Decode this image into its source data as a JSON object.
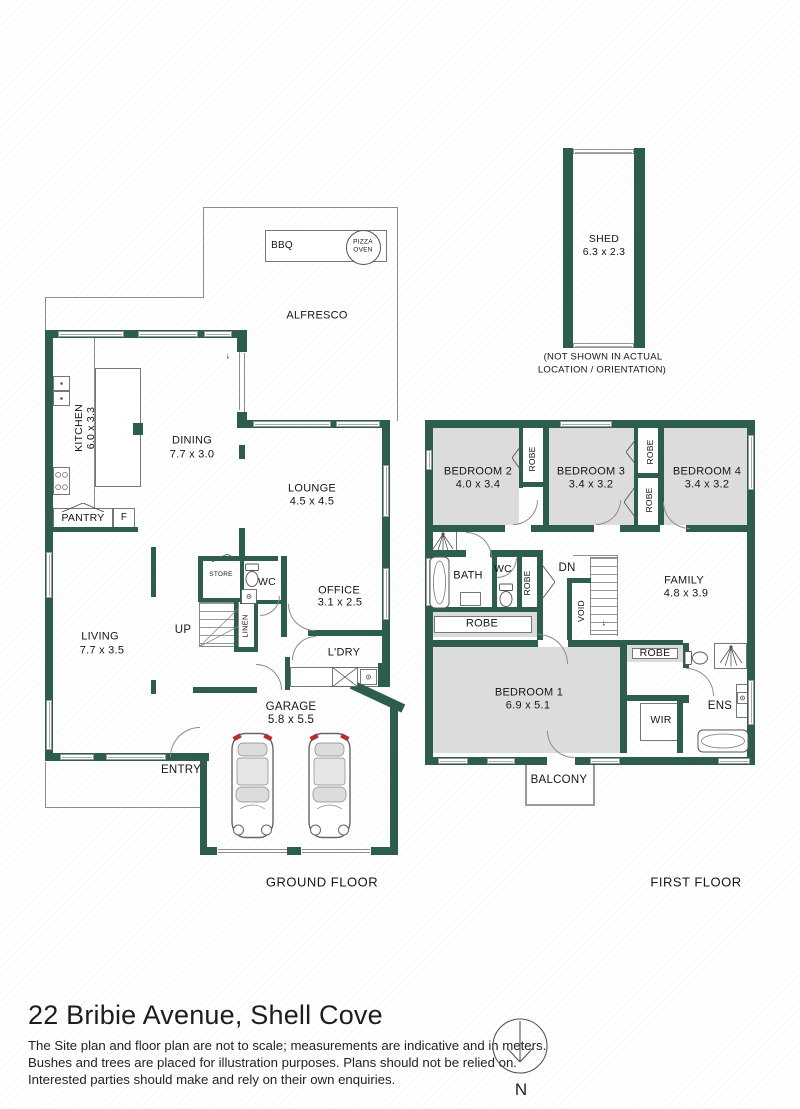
{
  "meta": {
    "title": "22 Bribie Avenue, Shell Cove",
    "disclaimer": [
      "The Site plan and floor plan are not to scale; measurements are indicative and in meters.",
      "Bushes and trees are placed for illustration purposes. Plans should not be relied on.",
      "Interested parties should make and rely on their own enquiries."
    ],
    "ground_floor_label": "GROUND FLOOR",
    "first_floor_label": "FIRST FLOOR",
    "compass_label": "N"
  },
  "colors": {
    "wall": "#2d5d4b",
    "room_fill": "#dcdcdc",
    "thin_line": "#8c8c8c",
    "text": "#161616",
    "tail_light": "#b03030"
  },
  "plan": {
    "walls": [
      [
        45,
        330,
        8,
        431
      ],
      [
        45,
        330,
        194,
        8
      ],
      [
        237,
        330,
        10,
        22
      ],
      [
        237,
        412,
        10,
        16
      ],
      [
        237,
        420,
        153,
        8
      ],
      [
        382,
        420,
        8,
        247
      ],
      [
        378,
        663,
        12,
        24
      ],
      [
        45,
        753,
        152,
        8
      ],
      [
        197,
        753,
        12,
        8
      ],
      [
        200,
        755,
        7,
        100
      ],
      [
        200,
        847,
        17,
        8
      ],
      [
        287,
        847,
        14,
        8
      ],
      [
        371,
        847,
        27,
        8
      ],
      [
        390,
        704,
        8,
        151
      ],
      [
        349,
        692,
        57,
        9,
        25
      ],
      [
        193,
        687,
        64,
        6
      ],
      [
        285,
        657,
        5,
        33
      ],
      [
        151,
        547,
        5,
        50
      ],
      [
        151,
        680,
        5,
        14
      ],
      [
        53,
        527,
        85,
        5
      ],
      [
        198,
        556,
        80,
        5
      ],
      [
        281,
        556,
        6,
        81
      ],
      [
        308,
        630,
        80,
        6
      ],
      [
        198,
        556,
        5,
        46
      ],
      [
        240,
        558,
        4,
        44
      ],
      [
        198,
        598,
        44,
        4
      ],
      [
        240,
        600,
        45,
        4
      ],
      [
        234,
        602,
        4,
        50
      ],
      [
        254,
        602,
        4,
        50
      ],
      [
        234,
        647,
        24,
        5
      ],
      [
        133,
        423,
        10,
        12
      ],
      [
        239,
        445,
        6,
        14
      ],
      [
        239,
        528,
        6,
        30
      ],
      [
        425,
        420,
        330,
        8
      ],
      [
        425,
        420,
        8,
        345
      ],
      [
        747,
        420,
        8,
        345
      ],
      [
        425,
        757,
        330,
        8
      ],
      [
        425,
        525,
        330,
        7
      ],
      [
        543,
        428,
        6,
        97
      ],
      [
        519,
        428,
        4,
        60
      ],
      [
        519,
        482,
        28,
        5
      ],
      [
        634,
        428,
        4,
        97
      ],
      [
        658,
        428,
        6,
        97
      ],
      [
        634,
        473,
        28,
        5
      ],
      [
        425,
        550,
        41,
        7
      ],
      [
        490,
        550,
        53,
        7
      ],
      [
        492,
        557,
        5,
        50
      ],
      [
        517,
        557,
        5,
        50
      ],
      [
        537,
        557,
        6,
        85
      ],
      [
        425,
        607,
        118,
        5
      ],
      [
        425,
        640,
        202,
        7
      ],
      [
        620,
        643,
        7,
        110
      ],
      [
        567,
        578,
        5,
        64
      ],
      [
        567,
        578,
        24,
        5
      ],
      [
        683,
        643,
        6,
        25
      ],
      [
        683,
        695,
        6,
        8
      ],
      [
        627,
        695,
        56,
        6
      ],
      [
        677,
        701,
        6,
        52
      ],
      [
        627,
        640,
        56,
        5
      ],
      [
        563,
        148,
        10,
        200
      ],
      [
        634,
        148,
        11,
        200
      ]
    ],
    "gaps": [
      [
        505,
        525,
        26,
        7
      ],
      [
        594,
        525,
        26,
        7
      ],
      [
        660,
        525,
        26,
        7
      ],
      [
        538,
        640,
        30,
        7
      ],
      [
        547,
        757,
        28,
        8
      ]
    ],
    "windows": [
      [
        58,
        331,
        66,
        6
      ],
      [
        138,
        331,
        60,
        6
      ],
      [
        204,
        331,
        28,
        6
      ],
      [
        253,
        421,
        78,
        6
      ],
      [
        336,
        421,
        44,
        6
      ],
      [
        46,
        552,
        6,
        46
      ],
      [
        46,
        700,
        6,
        50
      ],
      [
        383,
        465,
        6,
        52
      ],
      [
        383,
        568,
        6,
        52
      ],
      [
        60,
        754,
        34,
        6
      ],
      [
        106,
        754,
        60,
        6
      ],
      [
        560,
        421,
        52,
        6
      ],
      [
        426,
        450,
        6,
        20
      ],
      [
        426,
        558,
        6,
        48
      ],
      [
        748,
        435,
        6,
        55
      ],
      [
        748,
        680,
        6,
        45
      ],
      [
        438,
        758,
        30,
        6
      ],
      [
        487,
        758,
        28,
        6
      ],
      [
        590,
        758,
        30,
        6
      ],
      [
        718,
        758,
        32,
        6
      ],
      [
        573,
        149,
        61,
        5
      ],
      [
        573,
        343,
        61,
        5
      ]
    ],
    "fills": [
      [
        433,
        428,
        86,
        97
      ],
      [
        549,
        428,
        85,
        97
      ],
      [
        664,
        428,
        83,
        97
      ],
      [
        433,
        647,
        187,
        106
      ],
      [
        428,
        612,
        110,
        25
      ],
      [
        627,
        645,
        56,
        17
      ]
    ],
    "lines": [
      [
        203,
        207,
        195,
        1
      ],
      [
        397,
        207,
        1,
        214
      ],
      [
        203,
        207,
        1,
        91
      ],
      [
        45,
        297,
        158,
        1
      ],
      [
        45,
        297,
        1,
        34
      ],
      [
        45,
        762,
        1,
        46
      ],
      [
        45,
        807,
        156,
        1
      ],
      [
        300,
        230,
        1,
        32
      ],
      [
        94,
        338,
        1,
        170
      ],
      [
        573,
        555,
        45,
        1
      ],
      [
        617,
        555,
        1,
        81
      ],
      [
        218,
        849,
        69,
        1
      ],
      [
        218,
        852,
        69,
        1
      ],
      [
        302,
        849,
        68,
        1
      ],
      [
        302,
        852,
        68,
        1
      ],
      [
        239,
        348,
        1,
        62
      ],
      [
        244,
        353,
        1,
        60
      ]
    ],
    "benches": [
      [
        265,
        230,
        122,
        32
      ],
      [
        95,
        368,
        46,
        119
      ],
      [
        53,
        508,
        60,
        20
      ],
      [
        113,
        508,
        22,
        20
      ],
      [
        290,
        667,
        91,
        20
      ],
      [
        434,
        616,
        98,
        17
      ],
      [
        632,
        648,
        46,
        11
      ],
      [
        640,
        703,
        38,
        38
      ],
      [
        736,
        684,
        12,
        34
      ],
      [
        460,
        592,
        21,
        14
      ],
      [
        429,
        530,
        28,
        25
      ],
      [
        714,
        643,
        33,
        26
      ]
    ],
    "balcony": [
      525,
      762,
      70,
      44
    ],
    "doors": [
      {
        "x": 170,
        "y": 727,
        "r": 30,
        "c": "tl"
      },
      {
        "x": 288,
        "y": 604,
        "r": 27,
        "c": "bl"
      },
      {
        "x": 256,
        "y": 664,
        "r": 26,
        "c": "tr"
      },
      {
        "x": 260,
        "y": 596,
        "r": 20,
        "c": "br"
      },
      {
        "x": 292,
        "y": 636,
        "r": 24,
        "c": "tl"
      },
      {
        "x": 513,
        "y": 500,
        "r": 25,
        "c": "br"
      },
      {
        "x": 596,
        "y": 500,
        "r": 25,
        "c": "br"
      },
      {
        "x": 663,
        "y": 502,
        "r": 27,
        "c": "bl"
      },
      {
        "x": 466,
        "y": 532,
        "r": 26,
        "c": "tr"
      },
      {
        "x": 497,
        "y": 558,
        "r": 20,
        "c": "br"
      },
      {
        "x": 538,
        "y": 634,
        "r": 30,
        "c": "tr"
      },
      {
        "x": 547,
        "y": 731,
        "r": 27,
        "c": "bl"
      },
      {
        "x": 686,
        "y": 668,
        "r": 28,
        "c": "tr"
      }
    ],
    "stairs": [
      [
        199,
        602,
        40,
        45
      ],
      [
        590,
        557,
        28,
        78
      ]
    ],
    "fixtures": [
      {
        "k": "sink2",
        "x": 53,
        "y": 376,
        "w": 17,
        "h": 30
      },
      {
        "k": "stove",
        "x": 53,
        "y": 467,
        "w": 17,
        "h": 28
      },
      {
        "k": "toilet",
        "x": 244,
        "y": 563,
        "w": 16,
        "h": 24
      },
      {
        "k": "basin",
        "x": 241,
        "y": 589,
        "w": 16,
        "h": 15
      },
      {
        "k": "toilet",
        "x": 498,
        "y": 583,
        "w": 16,
        "h": 24
      },
      {
        "k": "toilet",
        "x": 688,
        "y": 646,
        "w": 16,
        "h": 24,
        "r": -90
      },
      {
        "k": "tub",
        "x": 429,
        "y": 556,
        "w": 21,
        "h": 53
      },
      {
        "k": "tub",
        "x": 697,
        "y": 729,
        "w": 52,
        "h": 24
      },
      {
        "k": "shower",
        "x": 431,
        "y": 531,
        "w": 24,
        "h": 23
      },
      {
        "k": "shower",
        "x": 718,
        "y": 644,
        "w": 26,
        "h": 24
      },
      {
        "k": "xbox",
        "x": 332,
        "y": 667,
        "w": 26,
        "h": 20
      },
      {
        "k": "basin",
        "x": 360,
        "y": 669,
        "w": 17,
        "h": 16
      },
      {
        "k": "basin",
        "x": 737,
        "y": 691,
        "w": 11,
        "h": 12
      },
      {
        "k": "circle",
        "x": 346,
        "y": 230,
        "w": 33,
        "h": 33
      },
      {
        "k": "car",
        "x": 230,
        "y": 731,
        "w": 45,
        "h": 109
      },
      {
        "k": "car",
        "x": 307,
        "y": 731,
        "w": 45,
        "h": 109
      },
      {
        "k": "chev",
        "x": 62,
        "y": 499,
        "w": 42,
        "h": 9,
        "d": "up"
      },
      {
        "k": "chev",
        "x": 212,
        "y": 549,
        "w": 30,
        "h": 8,
        "d": "up"
      },
      {
        "k": "chev",
        "x": 512,
        "y": 443,
        "w": 11,
        "h": 30,
        "d": "left"
      },
      {
        "k": "chev",
        "x": 626,
        "y": 438,
        "w": 11,
        "h": 28,
        "d": "left"
      },
      {
        "k": "chev",
        "x": 624,
        "y": 487,
        "w": 11,
        "h": 30,
        "d": "left"
      },
      {
        "k": "chev",
        "x": 543,
        "y": 566,
        "w": 12,
        "h": 32,
        "d": "right"
      },
      {
        "k": "diag",
        "x": 199,
        "y": 602,
        "w": 40,
        "h": 45
      }
    ],
    "labels": [
      {
        "t": "BBQ",
        "x": 282,
        "y": 246,
        "s": 10
      },
      {
        "t": "PIZZA\nOVEN",
        "x": 363,
        "y": 246,
        "s": 6.5
      },
      {
        "t": "ALFRESCO",
        "x": 317,
        "y": 316,
        "s": 11
      },
      {
        "t": "KITCHEN",
        "x": 79,
        "y": 428,
        "s": 10.5,
        "r": -90
      },
      {
        "t": "6.0 x 3.3",
        "x": 91,
        "y": 428,
        "s": 10.5,
        "r": -90
      },
      {
        "t": "DINING",
        "x": 192,
        "y": 441,
        "s": 11
      },
      {
        "t": "7.7 x 3.0",
        "x": 192,
        "y": 455,
        "s": 11
      },
      {
        "t": "LOUNGE",
        "x": 312,
        "y": 489,
        "s": 11
      },
      {
        "t": "4.5 x 4.5",
        "x": 312,
        "y": 502,
        "s": 11
      },
      {
        "t": "PANTRY",
        "x": 83,
        "y": 518,
        "s": 10.5
      },
      {
        "t": "F",
        "x": 124,
        "y": 518,
        "s": 10
      },
      {
        "t": "STORE",
        "x": 221,
        "y": 575,
        "s": 6.5
      },
      {
        "t": "WC",
        "x": 267,
        "y": 582,
        "s": 10.5
      },
      {
        "t": "LINEN",
        "x": 246,
        "y": 626,
        "s": 7.5,
        "r": -90
      },
      {
        "t": "OFFICE",
        "x": 339,
        "y": 591,
        "s": 11
      },
      {
        "t": "3.1 x 2.5",
        "x": 340,
        "y": 603,
        "s": 11
      },
      {
        "t": "UP",
        "x": 183,
        "y": 631,
        "s": 11.5
      },
      {
        "t": "L'DRY",
        "x": 344,
        "y": 653,
        "s": 11
      },
      {
        "t": "LIVING",
        "x": 100,
        "y": 637,
        "s": 11
      },
      {
        "t": "7.7 x 3.5",
        "x": 102,
        "y": 651,
        "s": 11
      },
      {
        "t": "ENTRY",
        "x": 181,
        "y": 771,
        "s": 11.5
      },
      {
        "t": "GARAGE",
        "x": 291,
        "y": 708,
        "s": 11.5
      },
      {
        "t": "5.8 x 5.5",
        "x": 291,
        "y": 721,
        "s": 11.5
      },
      {
        "t": "↓",
        "x": 228,
        "y": 356,
        "s": 9
      },
      {
        "t": "BEDROOM 2",
        "x": 478,
        "y": 472,
        "s": 11
      },
      {
        "t": "4.0 x 3.4",
        "x": 478,
        "y": 485,
        "s": 11
      },
      {
        "t": "ROBE",
        "x": 532,
        "y": 459,
        "s": 8.5,
        "r": -90
      },
      {
        "t": "BEDROOM 3",
        "x": 591,
        "y": 472,
        "s": 11
      },
      {
        "t": "3.4 x 3.2",
        "x": 591,
        "y": 485,
        "s": 11
      },
      {
        "t": "ROBE",
        "x": 650,
        "y": 452,
        "s": 8.5,
        "r": -90
      },
      {
        "t": "ROBE",
        "x": 649,
        "y": 500,
        "s": 8.5,
        "r": -90
      },
      {
        "t": "BEDROOM 4",
        "x": 707,
        "y": 472,
        "s": 11
      },
      {
        "t": "3.4 x 3.2",
        "x": 707,
        "y": 485,
        "s": 11
      },
      {
        "t": "BATH",
        "x": 468,
        "y": 576,
        "s": 11
      },
      {
        "t": "WC",
        "x": 503,
        "y": 569,
        "s": 10.5
      },
      {
        "t": "ROBE",
        "x": 527,
        "y": 583,
        "s": 8.5,
        "r": -90
      },
      {
        "t": "DN",
        "x": 567,
        "y": 569,
        "s": 11.5
      },
      {
        "t": "VOID",
        "x": 581,
        "y": 611,
        "s": 8.5,
        "r": -90
      },
      {
        "t": "↓",
        "x": 604,
        "y": 623,
        "s": 9
      },
      {
        "t": "FAMILY",
        "x": 684,
        "y": 581,
        "s": 11
      },
      {
        "t": "4.8 x 3.9",
        "x": 686,
        "y": 594,
        "s": 11
      },
      {
        "t": "ROBE",
        "x": 482,
        "y": 624,
        "s": 11
      },
      {
        "t": "BEDROOM 1",
        "x": 529,
        "y": 693,
        "s": 11
      },
      {
        "t": "6.9 x 5.1",
        "x": 528,
        "y": 706,
        "s": 11
      },
      {
        "t": "ROBE",
        "x": 655,
        "y": 653,
        "s": 10.5
      },
      {
        "t": "WIR",
        "x": 661,
        "y": 720,
        "s": 10.5
      },
      {
        "t": "ENS",
        "x": 720,
        "y": 707,
        "s": 11.5
      },
      {
        "t": "BALCONY",
        "x": 559,
        "y": 781,
        "s": 11.5
      },
      {
        "t": "SHED",
        "x": 604,
        "y": 239,
        "s": 10.5
      },
      {
        "t": "6.3 x 2.3",
        "x": 604,
        "y": 252,
        "s": 10.5
      },
      {
        "t": "(NOT SHOWN IN ACTUAL",
        "x": 603,
        "y": 357,
        "s": 9.5
      },
      {
        "t": "LOCATION / ORIENTATION)",
        "x": 602,
        "y": 370,
        "s": 9.5
      }
    ]
  }
}
